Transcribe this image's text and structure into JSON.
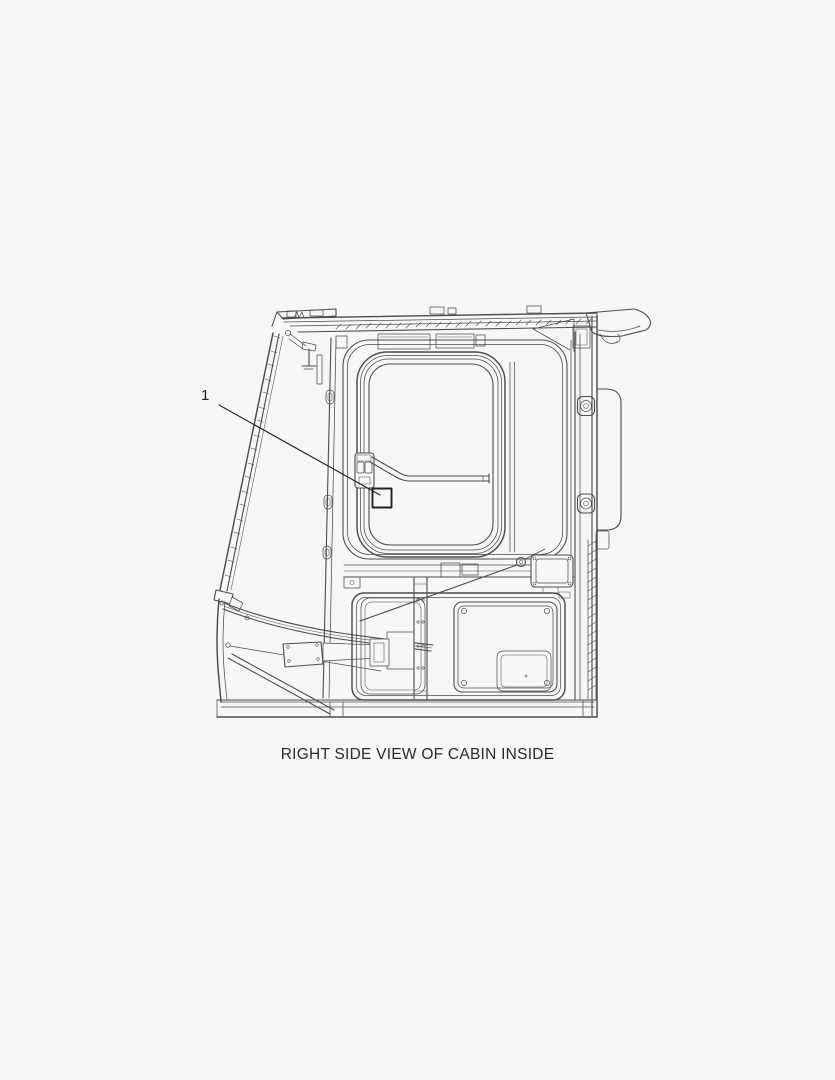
{
  "page": {
    "background_color": "#f7f7f7",
    "line_color": "#4d4d4d",
    "accent_color": "#222222"
  },
  "figure": {
    "type": "technical-line-drawing",
    "subject": "excavator cab right side interior view",
    "caption": "RIGHT SIDE VIEW OF CABIN INSIDE",
    "callout": {
      "label": "1"
    }
  }
}
